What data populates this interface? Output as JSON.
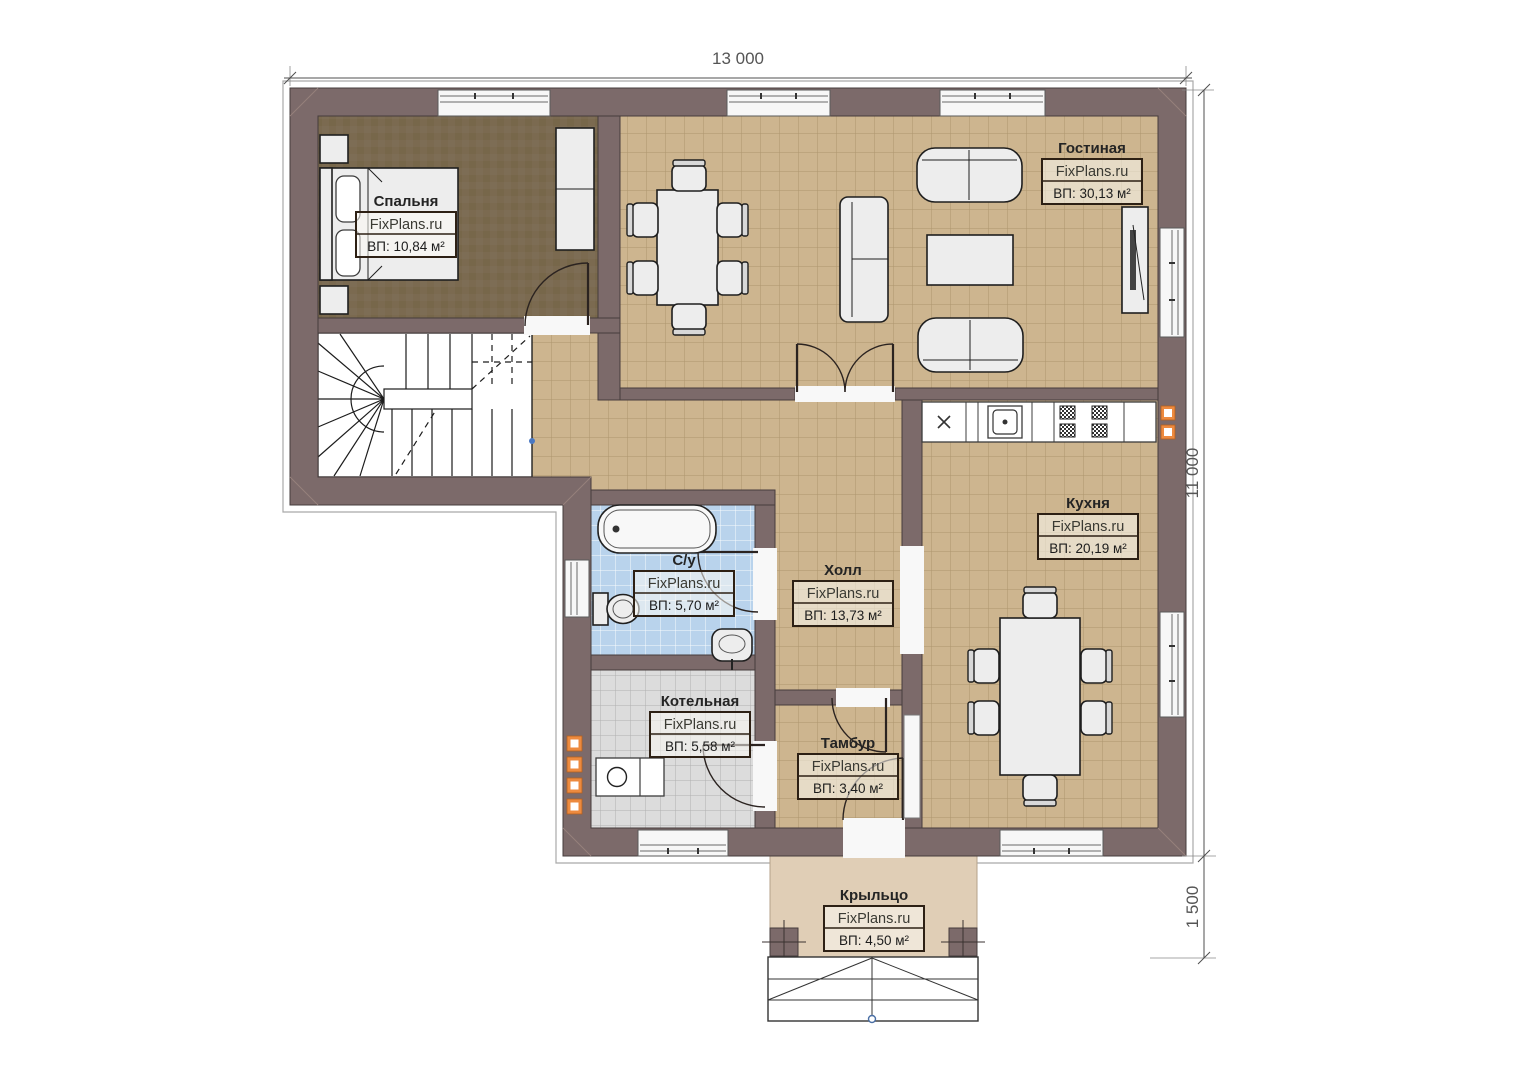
{
  "plan": {
    "dimensions": {
      "width_label": "13 000",
      "height_label": "11 000",
      "porch_label": "1 500"
    },
    "rooms": [
      {
        "key": "bedroom",
        "name": "Спальня",
        "watermark": "FixPlans.ru",
        "area": "ВП: 10,84 м²"
      },
      {
        "key": "living_room",
        "name": "Гостиная",
        "watermark": "FixPlans.ru",
        "area": "ВП: 30,13 м²"
      },
      {
        "key": "kitchen",
        "name": "Кухня",
        "watermark": "FixPlans.ru",
        "area": "ВП: 20,19 м²"
      },
      {
        "key": "bathroom",
        "name": "С/у",
        "watermark": "FixPlans.ru",
        "area": "ВП: 5,70 м²"
      },
      {
        "key": "hall",
        "name": "Холл",
        "watermark": "FixPlans.ru",
        "area": "ВП: 13,73 м²"
      },
      {
        "key": "boiler_room",
        "name": "Котельная",
        "watermark": "FixPlans.ru",
        "area": "ВП: 5,58 м²"
      },
      {
        "key": "vestibule",
        "name": "Тамбур",
        "watermark": "FixPlans.ru",
        "area": "ВП: 3,40 м²"
      },
      {
        "key": "porch",
        "name": "Крыльцо",
        "watermark": "FixPlans.ru",
        "area": "ВП: 4,50 м²"
      }
    ],
    "colors": {
      "wall": "#7c6a6a",
      "floor_tile": "#cdb58f",
      "bedroom_floor": "#7b6a50",
      "bathroom_tile": "#b9d3ec",
      "boiler_tile": "#dcdcdc",
      "porch_floor": "#e0ceb6",
      "vent_accent": "#ed8a3f"
    }
  }
}
